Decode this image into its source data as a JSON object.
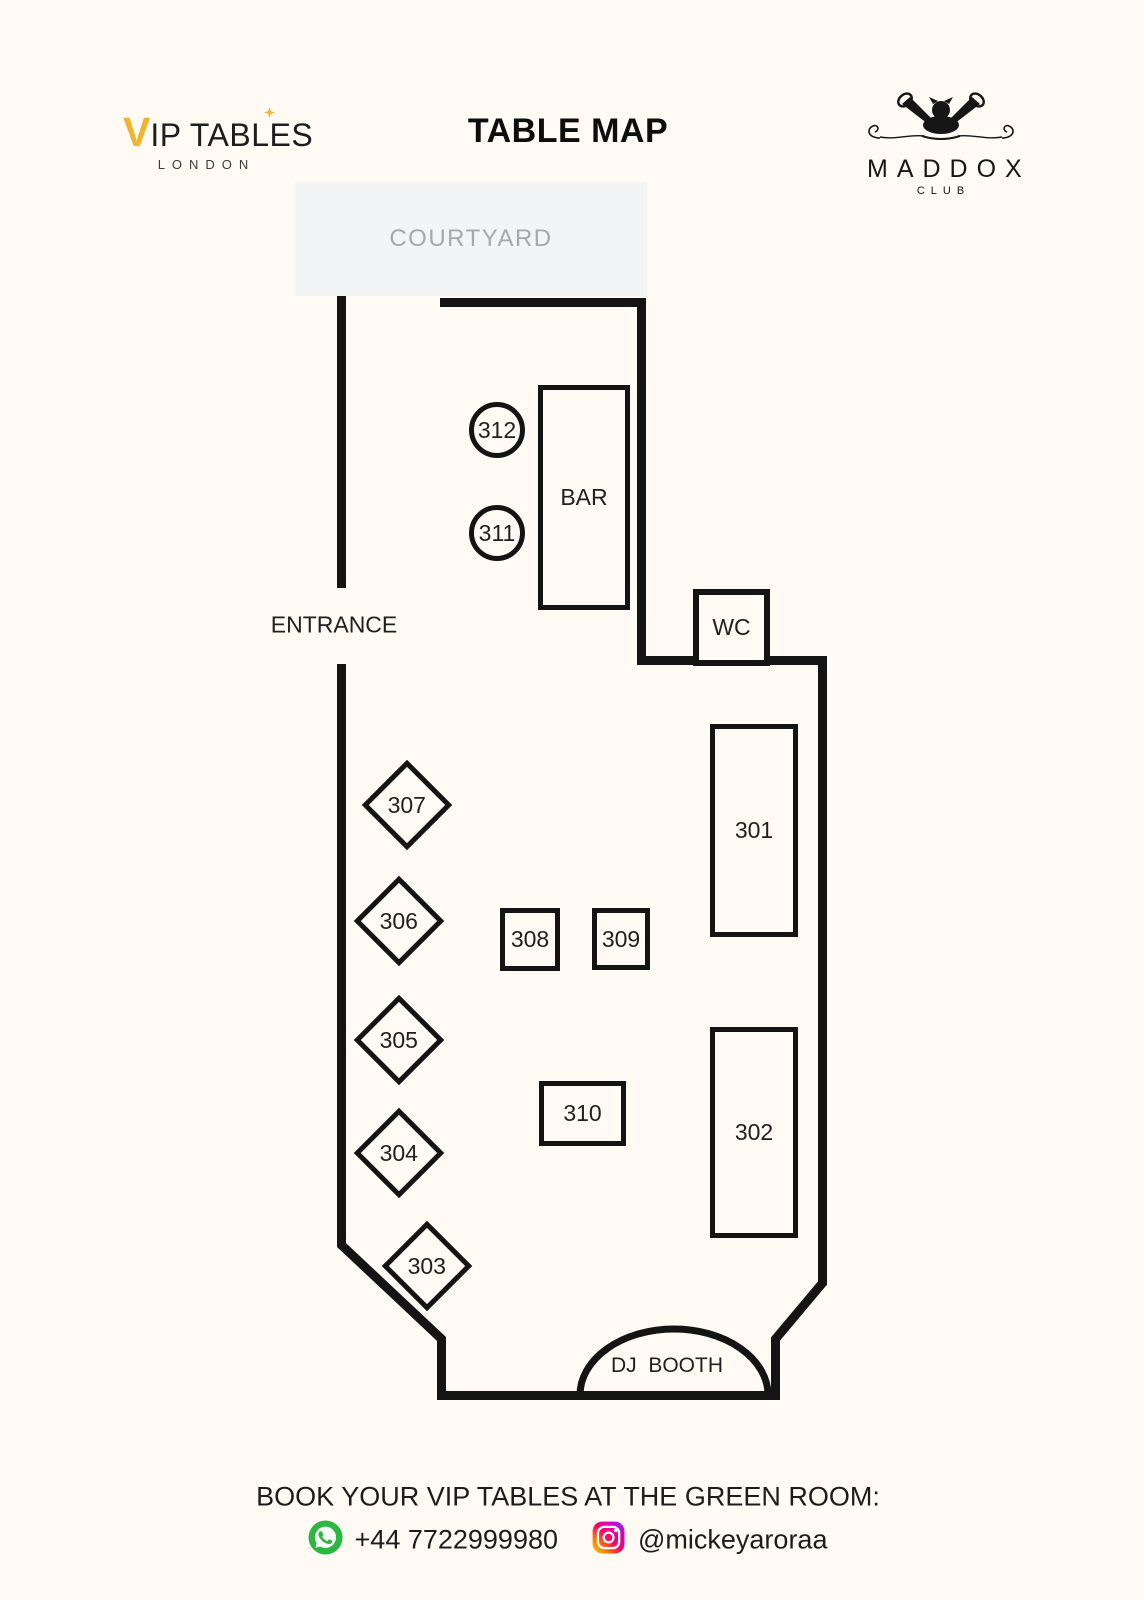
{
  "colors": {
    "background": "#FFFBF4",
    "wall": "#141414",
    "accent_gold": "#F2B42B",
    "courtyard_bg": "#F3F4F6",
    "courtyard_text": "#A8A8AB",
    "whatsapp_green": "#2BB741",
    "instagram_gradient": [
      "#FFD600",
      "#FF7A00",
      "#FF0069",
      "#D300C5",
      "#7638FA"
    ]
  },
  "icons": {
    "vip_sparkle": "four-point-star",
    "maddox_emblem": "dog-with-gramophone-horns",
    "whatsapp": "white-phone-in-green-circle",
    "instagram": "white-camera-on-gradient-square"
  },
  "header": {
    "vip_logo": {
      "v": "V",
      "wordmark": "IP TABLES",
      "subtitle": "LONDON"
    },
    "title": "TABLE MAP",
    "maddox_logo": {
      "name": "MADDOX",
      "subtitle": "CLUB"
    }
  },
  "map": {
    "areas": {
      "courtyard": "COURTYARD",
      "entrance": "ENTRANCE",
      "bar": "BAR",
      "wc": "WC",
      "dj_booth": "DJ  BOOTH"
    },
    "tables": {
      "t301": "301",
      "t302": "302",
      "t303": "303",
      "t304": "304",
      "t305": "305",
      "t306": "306",
      "t307": "307",
      "t308": "308",
      "t309": "309",
      "t310": "310",
      "t311": "311",
      "t312": "312"
    }
  },
  "footer": {
    "heading": "BOOK YOUR VIP TABLES AT THE GREEN ROOM:",
    "whatsapp_number": "+44 7722999980",
    "instagram_handle": "@mickeyaroraa"
  }
}
